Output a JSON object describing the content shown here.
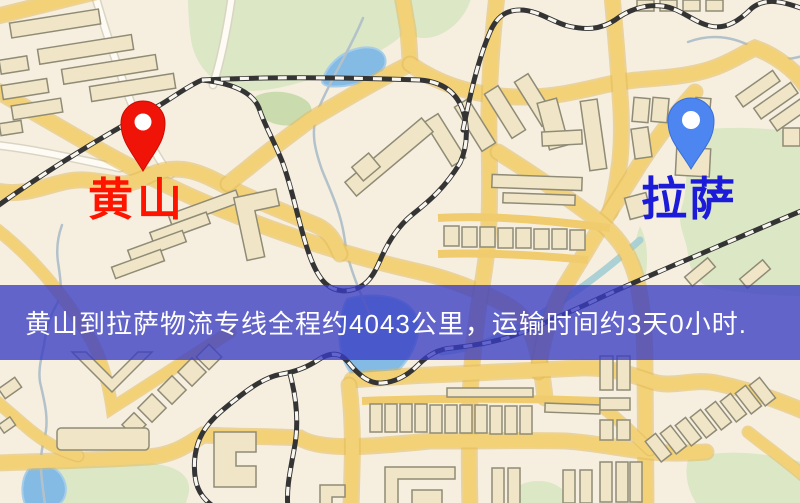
{
  "banner": {
    "text": "黄山到拉萨物流专线全程约4043公里，运输时间约3天0小时.",
    "background_color": "#3c3cc3",
    "background_opacity": 0.78,
    "text_color": "#ffffff"
  },
  "markers": {
    "origin": {
      "name": "黄山",
      "pin_color": "#f01408",
      "label_color": "#ff1400"
    },
    "destination": {
      "name": "拉萨",
      "pin_color": "#4d86f0",
      "label_color": "#1b1bd8"
    }
  },
  "map": {
    "style": "cartoon-street-map",
    "background_color": "#f6efe0",
    "road_color": "#f3d277",
    "minor_road_color": "#fdfbf3",
    "park_color": "#dbe7c5",
    "water_color": "#84bbe4",
    "building_color": "#f0e6c7",
    "railway_style": "black-white-dashed"
  }
}
